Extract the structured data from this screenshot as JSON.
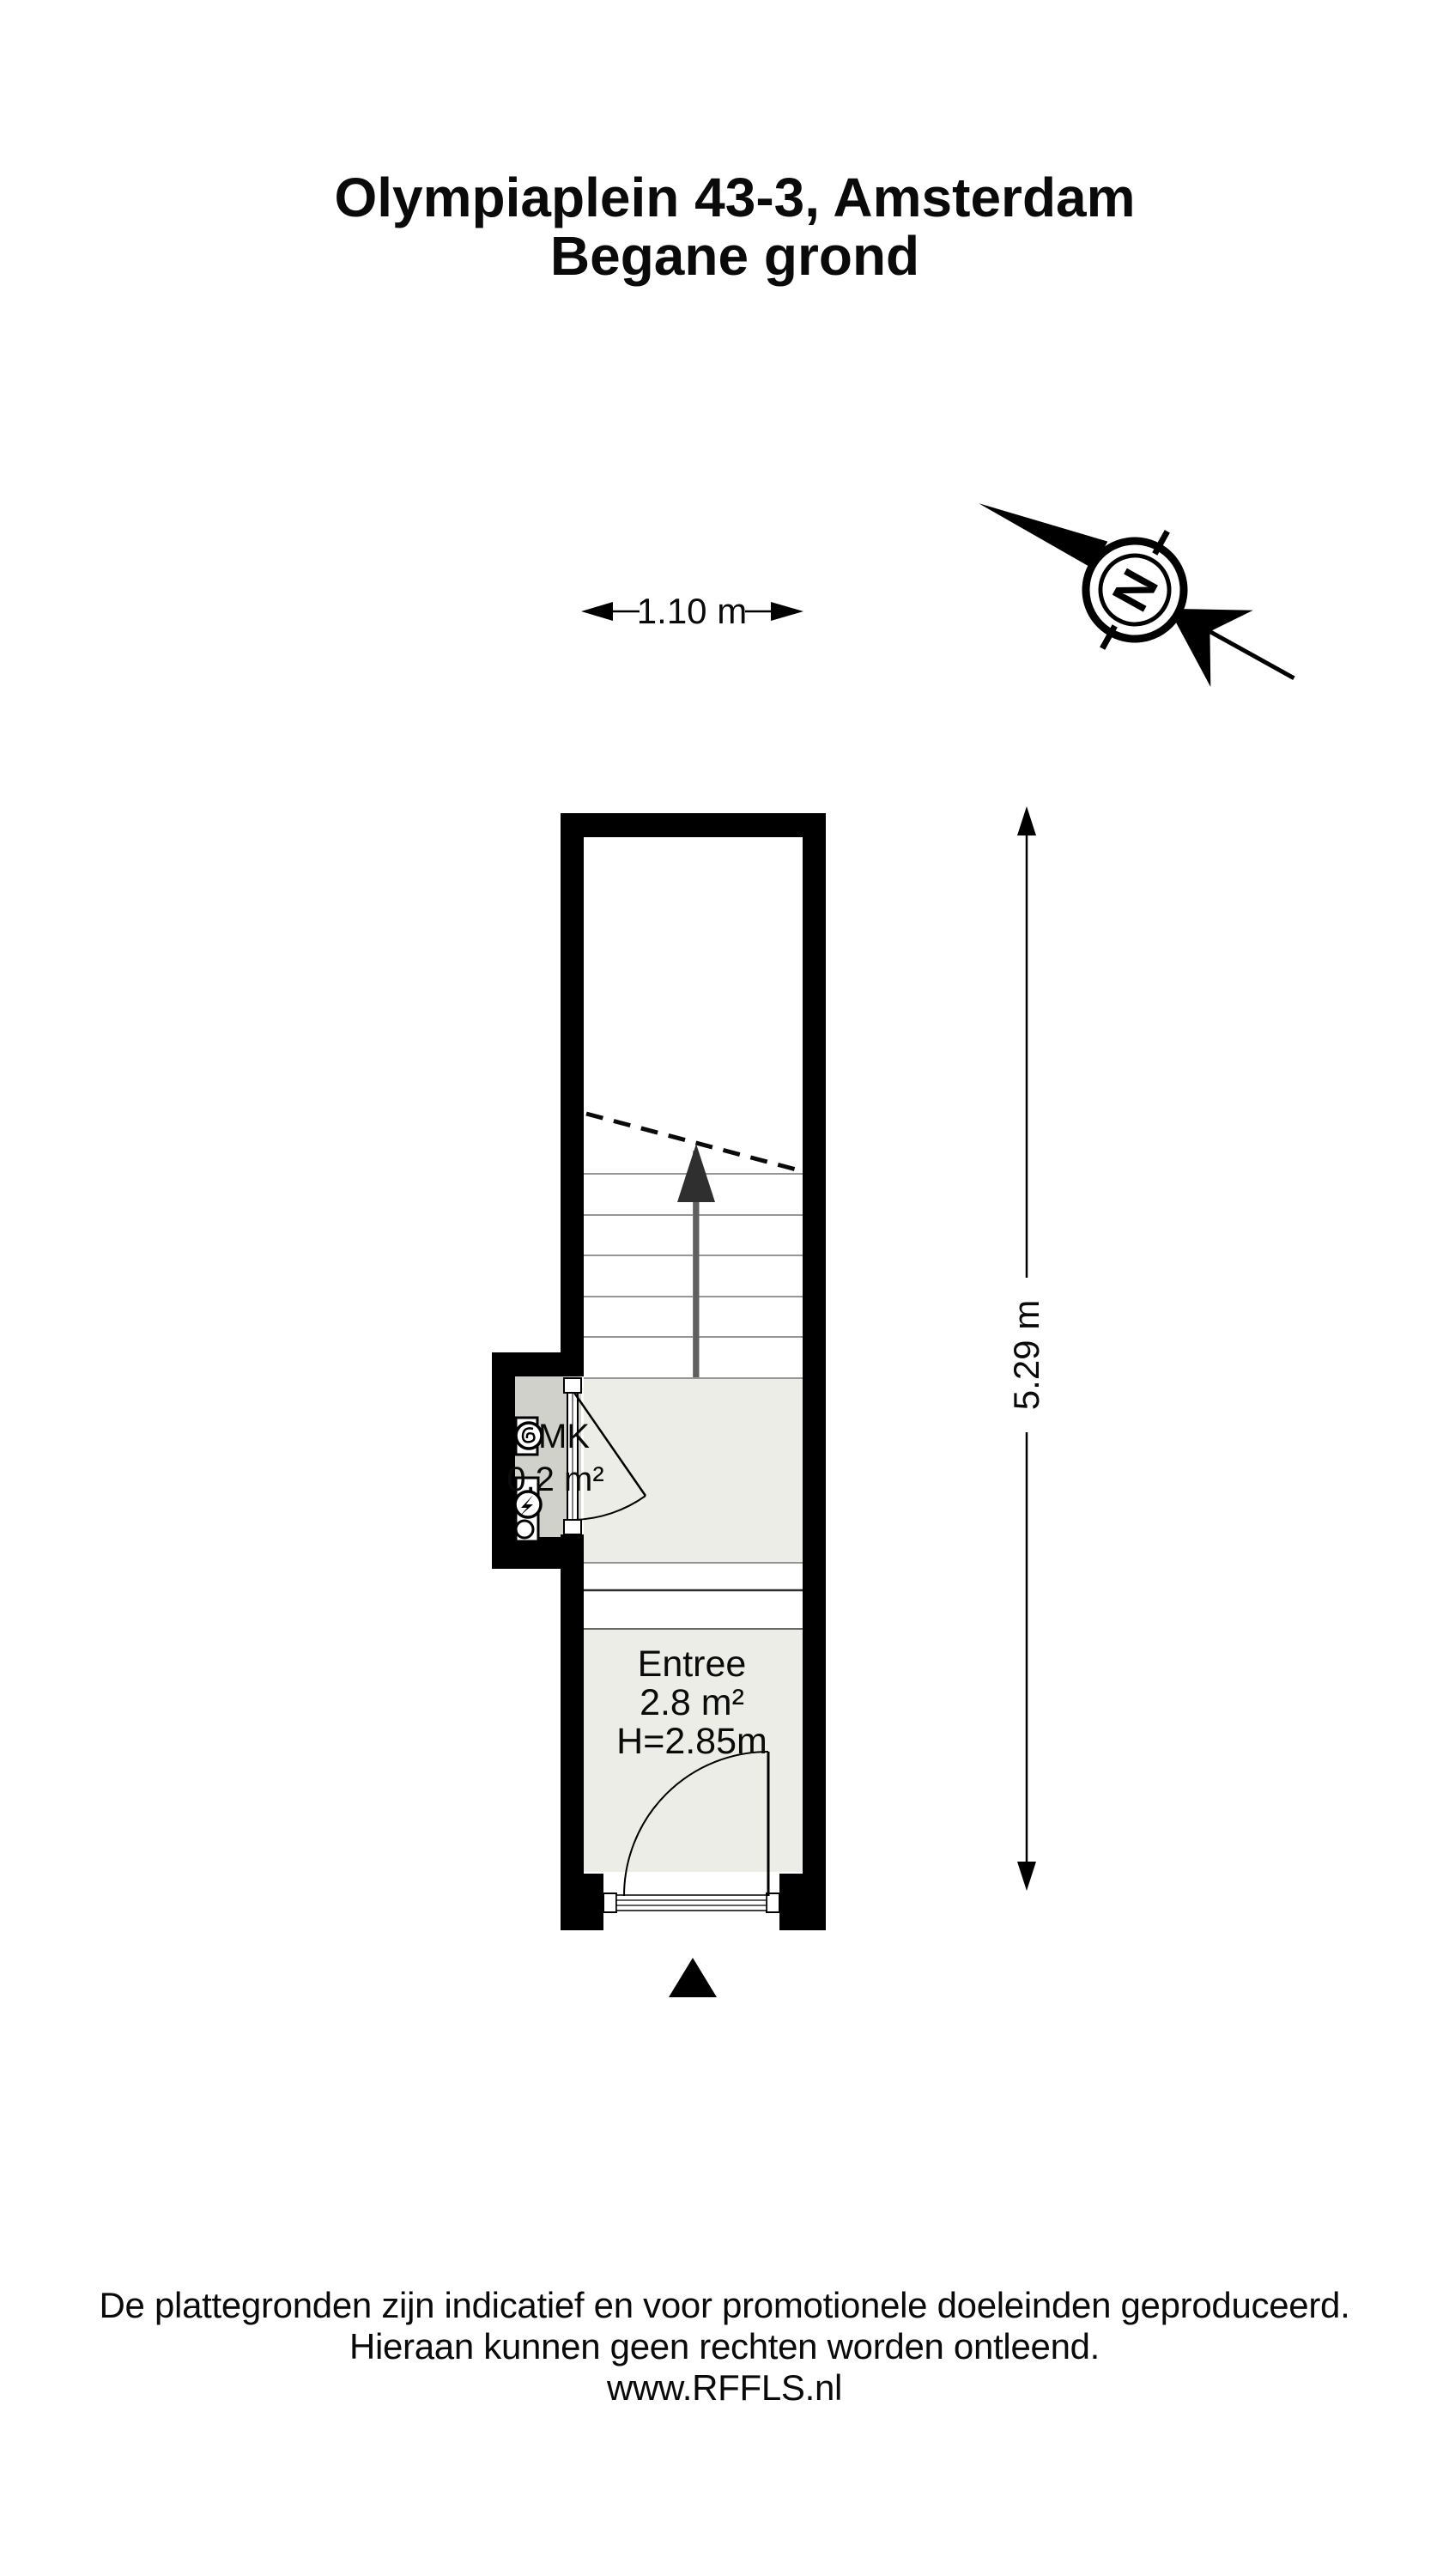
{
  "title": {
    "line1": "Olympiaplein 43-3, Amsterdam",
    "line2": "Begane grond"
  },
  "dimensions": {
    "width_label": "1.10 m",
    "height_label": "5.29 m"
  },
  "compass": {
    "letter": "N"
  },
  "rooms": {
    "mk": {
      "name": "MK",
      "area": "0.2 m²"
    },
    "entree": {
      "name": "Entree",
      "area": "2.8 m²",
      "ceiling_height": "H=2.85m"
    }
  },
  "footer": {
    "line1": "De plattegronden zijn indicatief en voor promotionele doeleinden geproduceerd.",
    "line2": "Hieraan kunnen geen rechten worden ontleend.",
    "line3": "www.RFFLS.nl"
  },
  "colors": {
    "wall": "#000000",
    "floor_light": "#ecede7",
    "floor_dark": "#d0d1ca",
    "tread_line": "#969696",
    "stair_arrow": "#2f2f2f",
    "text": "#0a0a0a"
  }
}
